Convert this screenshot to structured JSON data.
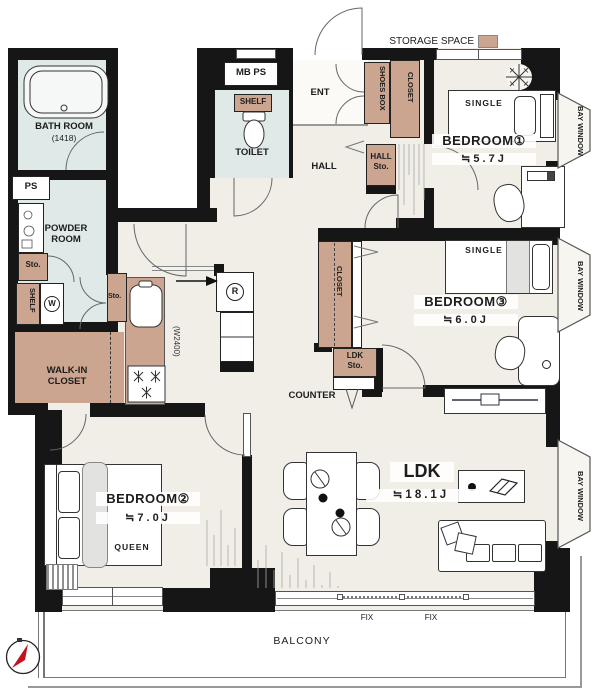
{
  "legend": {
    "storage_space": "STORAGE SPACE"
  },
  "rooms": {
    "bathroom": {
      "name": "BATH ROOM",
      "size": "(1418)"
    },
    "powder_room": {
      "line1": "POWDER",
      "line2": "ROOM"
    },
    "toilet": {
      "name": "TOILET"
    },
    "entrance": {
      "name": "ENT"
    },
    "hall": {
      "name": "HALL"
    },
    "bedroom1": {
      "name": "BEDROOM①",
      "size": "≒5.7J",
      "bed": "SINGLE"
    },
    "bedroom2": {
      "name": "BEDROOM②",
      "size": "≒7.0J",
      "bed": "QUEEN"
    },
    "bedroom3": {
      "name": "BEDROOM③",
      "size": "≒6.0J",
      "bed": "SINGLE"
    },
    "ldk": {
      "name": "LDK",
      "size": "≒18.1J"
    },
    "walk_in_closet": {
      "line1": "WALK-IN",
      "line2": "CLOSET"
    },
    "balcony": {
      "name": "BALCONY"
    }
  },
  "storage": {
    "shoes_box": "SHOES BOX",
    "hall_closet": "CLOSET",
    "hall_sto_line1": "HALL",
    "hall_sto_line2": "Sto.",
    "shelf_toilet": "SHELF",
    "shelf_powder": "SHELF",
    "sto_powder": "Sto.",
    "sto_kitchen": "Sto.",
    "bedroom3_closet": "CLOSET",
    "ldk_sto_line1": "LDK",
    "ldk_sto_line2": "Sto.",
    "counter": "COUNTER"
  },
  "fixtures": {
    "ps": "PS",
    "mb_ps": "MB PS",
    "washer": "W",
    "fridge": "R",
    "kitchen_width": "(W2400)"
  },
  "windows": {
    "bay": "BAY WINDOW",
    "fix_left": "FIX",
    "fix_right": "FIX"
  },
  "colors": {
    "wall": "#161616",
    "floor": "#f1eee7",
    "wet_floor": "#dfe9e8",
    "storage": "#cba58f",
    "bay_floor": "#f7f5ef",
    "compass_red": "#c3121c"
  }
}
